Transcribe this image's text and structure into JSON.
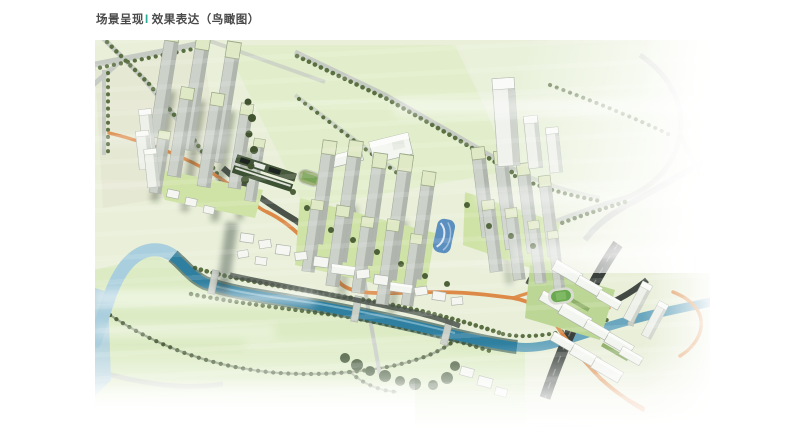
{
  "header": {
    "section": "场景呈现",
    "divider": "I",
    "title": "效果表达（鸟瞰图）"
  },
  "palette": {
    "accent_teal": "#2aab97",
    "title_text": "#4a4a4a",
    "page_background": "#ffffff",
    "field_green": "#e7eed6",
    "lawn_green": "#cfe3a6",
    "tree_green": "#4f6238",
    "roof_green": "#e0e9c6",
    "river_blue": "#2f7fa0",
    "river_light_blue": "#a9cedd",
    "greenway_orange": "#dd8a48",
    "road_gray": "#c6cbc3",
    "arterial_dark": "#3a403b",
    "building_white": "#f3f5f0",
    "building_gray": "#ccd1ca",
    "glass_blue": "#5b8fc0"
  }
}
